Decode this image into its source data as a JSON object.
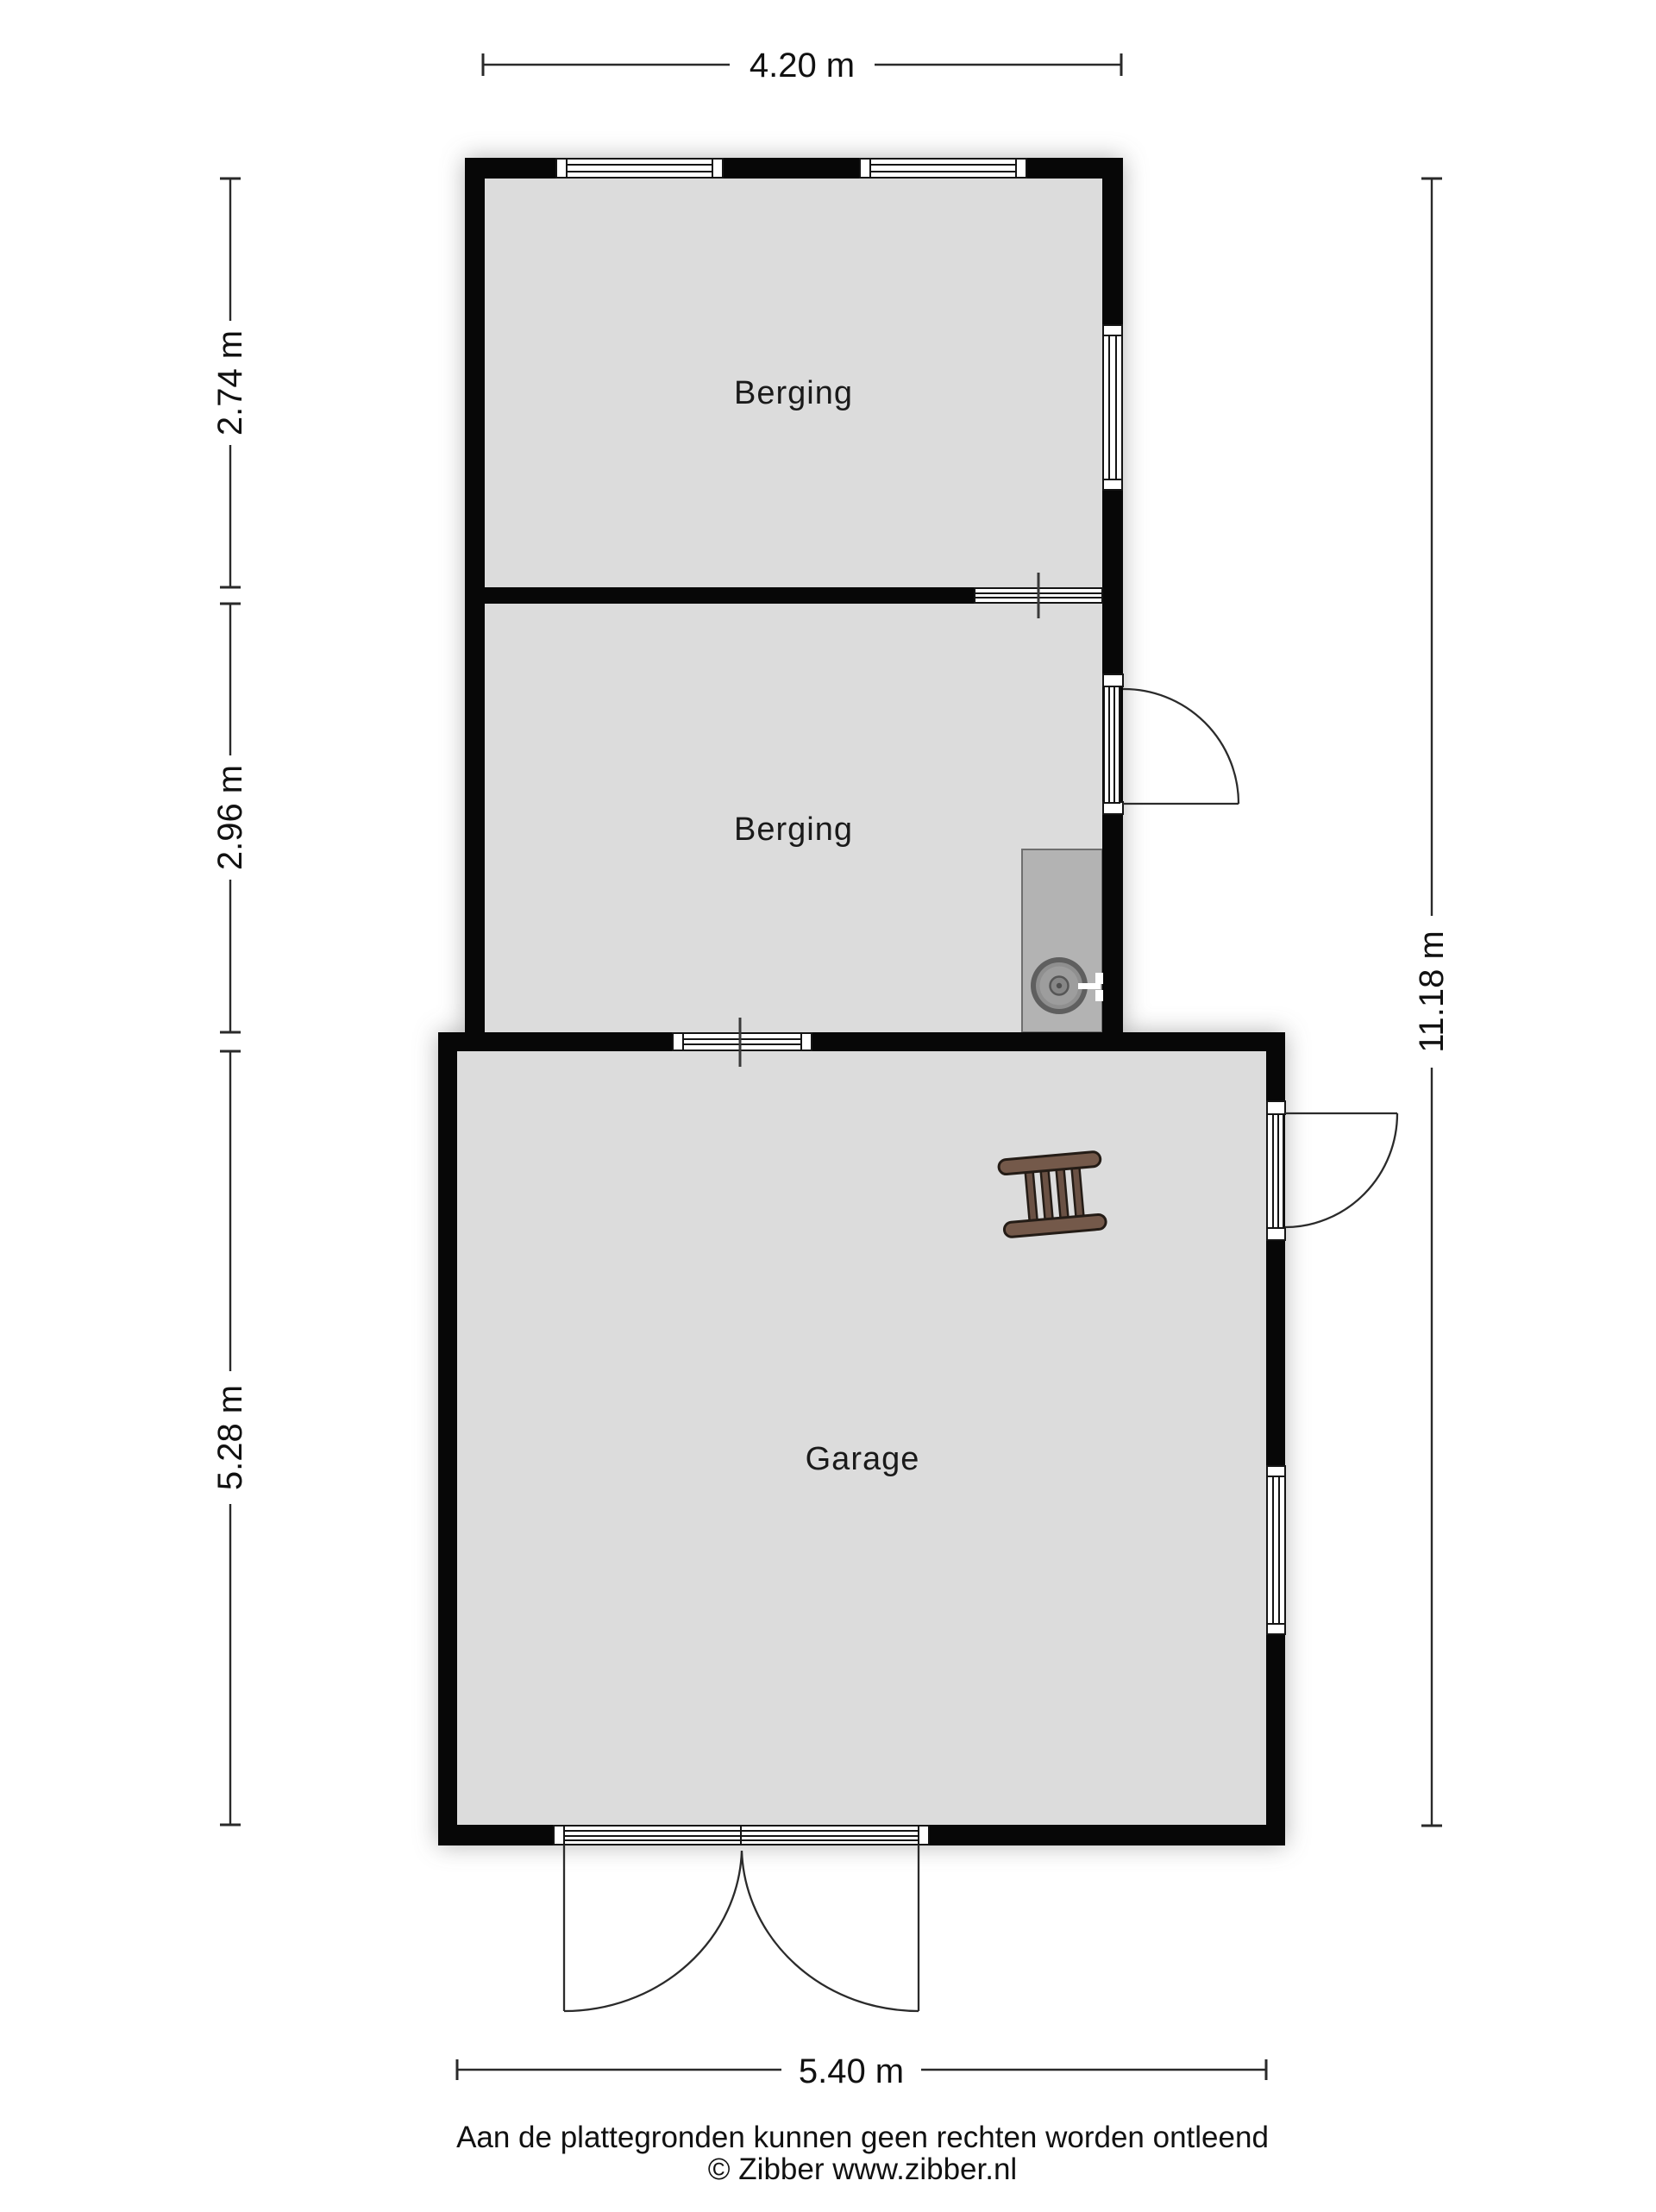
{
  "plan": {
    "rooms": [
      {
        "label": "Berging"
      },
      {
        "label": "Berging"
      },
      {
        "label": "Garage"
      }
    ],
    "dimensions": {
      "top": "4.20 m",
      "left_top": "2.74 m",
      "left_middle": "2.96 m",
      "left_bottom": "5.28 m",
      "right": "11.18 m",
      "bottom": "5.40 m"
    },
    "footer": {
      "disclaimer": "Aan de plattegronden kunnen geen rechten worden ontleend",
      "copyright": "© Zibber www.zibber.nl"
    },
    "icons": {
      "sink": "sink-icon",
      "ladder": "ladder-icon",
      "windows": "window-icon",
      "doors": "door-swing-icon"
    },
    "colors": {
      "floor": "#dcdcdc",
      "wall": "#070707",
      "counter": "#b3b3b3",
      "ladder_wood": "#74594a",
      "ladder_rung": "#6a5144",
      "sink_outer": "#5f5f5f",
      "sink_mid": "#8f8f8f",
      "sink_inner": "#9d9d9d",
      "sink_drain": "#868686"
    }
  }
}
